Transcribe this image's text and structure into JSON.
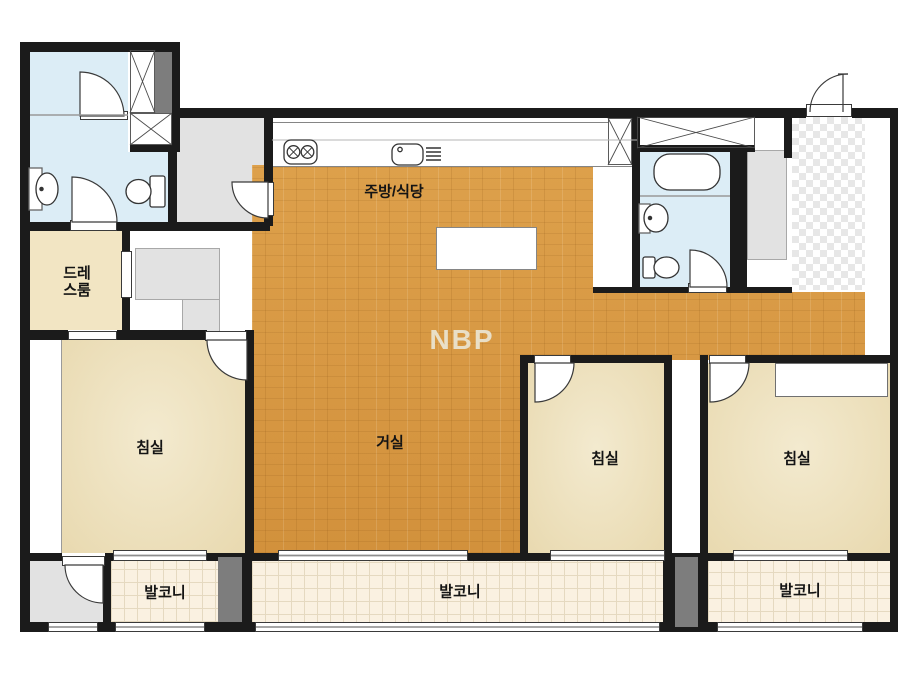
{
  "watermark": "NBP",
  "rooms": {
    "kitchen_dining": {
      "label": "주방/식당"
    },
    "dress_room": {
      "label": "드레\n스룸"
    },
    "living_room": {
      "label": "거실"
    },
    "bedroom_left": {
      "label": "침실"
    },
    "bedroom_center": {
      "label": "침실"
    },
    "bedroom_right": {
      "label": "침실"
    },
    "balcony_left": {
      "label": "발코니"
    },
    "balcony_center": {
      "label": "발코니"
    },
    "balcony_right": {
      "label": "발코니"
    }
  },
  "fixture_icons": [
    "stove-icon",
    "kitchen-sink-icon",
    "dish-rack-icon",
    "island-table",
    "bathtub-icon",
    "washbasin-icon",
    "toilet-icon",
    "door-swing-icon",
    "window-icon",
    "wardrobe-hatch-icon",
    "entry-checker-tile"
  ],
  "colors": {
    "wall": "#1b1b1b",
    "wood_floor": "#d99a41",
    "bedroom_floor": "#ece0bd",
    "dressroom_floor": "#f2e5c3",
    "bathroom_floor": "#dcedf6",
    "gray_area": "#e2e2e2",
    "dark_gray_block": "#7d7d7d",
    "balcony_tile": "#faf1e1",
    "watermark_color": "#e9dfc7"
  }
}
